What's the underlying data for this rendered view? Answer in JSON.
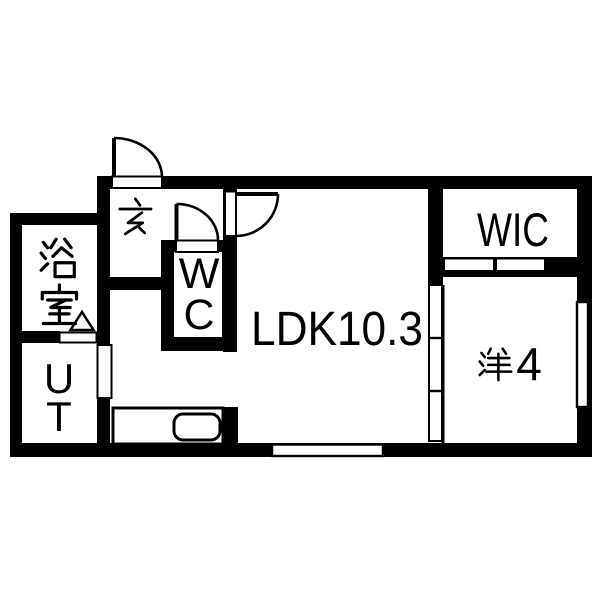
{
  "plan": {
    "type": "apartment-floor-plan",
    "colors": {
      "background": "#ffffff",
      "walls": "#000000",
      "lines": "#000000"
    },
    "rooms": {
      "genkan": {
        "label": "玄"
      },
      "bathroom": {
        "label": "浴室",
        "char1": "浴",
        "char2": "室"
      },
      "wc": {
        "label": "WC",
        "char1": "W",
        "char2": "C"
      },
      "ut": {
        "label": "UT",
        "char1": "U",
        "char2": "T"
      },
      "ldk": {
        "label": "LDK10.3"
      },
      "wic": {
        "label": "WIC"
      },
      "western": {
        "label": "洋4",
        "number": "4"
      }
    },
    "fixtures": {
      "doors": [
        "entrance-hinged-door",
        "wc-hinged-door",
        "ldk-hinged-door",
        "bathroom-door-triangle-marker",
        "wic-sliding-door-2panel",
        "ldk-western-sliding-door-3panel",
        "ut-sliding-door"
      ],
      "windows": [
        "right-wall-window",
        "bottom-wall-window"
      ],
      "kitchen": [
        "kitchen-counter",
        "kitchen-sink"
      ]
    }
  }
}
